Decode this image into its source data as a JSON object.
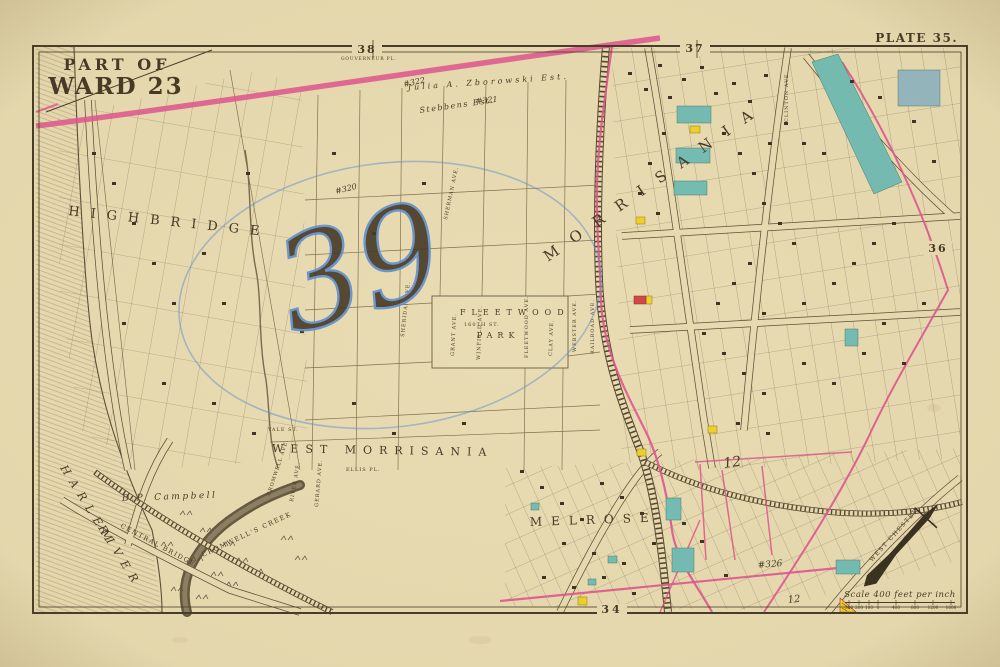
{
  "map": {
    "title_line1": "PART OF",
    "title_line2": "WARD 23",
    "plate_label": "PLATE 35.",
    "adjacent_plates": {
      "top_left": "38",
      "top_right": "37",
      "right": "36",
      "bottom": "34"
    }
  },
  "places": {
    "highbridge": "HIGHBRIDGE",
    "morrisania": "MORRISANIA",
    "west_morrisania": "WEST MORRISANIA",
    "melrose": "MELROSE",
    "fleetwood": "FLEETWOOD",
    "park": "PARK",
    "harlem": "HARLEM",
    "river": "RIVER",
    "cromwells_creek": "CROMWELL'S CREEK",
    "central_bridge": "CENTRAL BRIDGE",
    "west_chester": "WEST CHESTER",
    "campbell_estate": "D.P. Campbell",
    "zborowski_estate": "Julia A. Zborowski Est.",
    "stebbens_estate": "Stebbens Est."
  },
  "streets": {
    "gouverneur": "GOUVERNEUR PL.",
    "clinton": "CLINTON AVE.",
    "railroad": "RAILROAD AVE.",
    "webster": "WEBSTER AVE.",
    "clay": "CLAY AVE.",
    "fleetwood_ave": "FLEETWOOD AVE.",
    "winfield": "WINFIELD AVE.",
    "grant": "GRANT AVE.",
    "sheridan": "SHERIDAN AVE.",
    "sherman": "SHERMAN AVE.",
    "gerard": "GERARD AVE.",
    "river_ave": "RIVER AVE.",
    "cromwell": "CROMWELL AVE.",
    "ellis": "ELLIS PL.",
    "yale": "YALE ST.",
    "st_160": "160TH ST."
  },
  "annotations": {
    "blue_plot_number": "39",
    "purple_320": "#320",
    "purple_321": "#321",
    "purple_322": "#322",
    "purple_326": "#326",
    "red_12": "12",
    "purple_12": "12"
  },
  "scale": {
    "label": "Scale 400 feet per inch",
    "ticks": [
      "300",
      "200",
      "100",
      "0",
      "400",
      "800",
      "1200",
      "1600"
    ]
  },
  "colors": {
    "paper": "#e9dcb2",
    "ink": "#473c28",
    "pink": "#e0558f",
    "teal": "#74bdb4",
    "yellow": "#f0d228",
    "blue_pencil": "#5f8fd0",
    "purple_ink": "#6a4fb8",
    "red_ink": "#d84a70"
  }
}
